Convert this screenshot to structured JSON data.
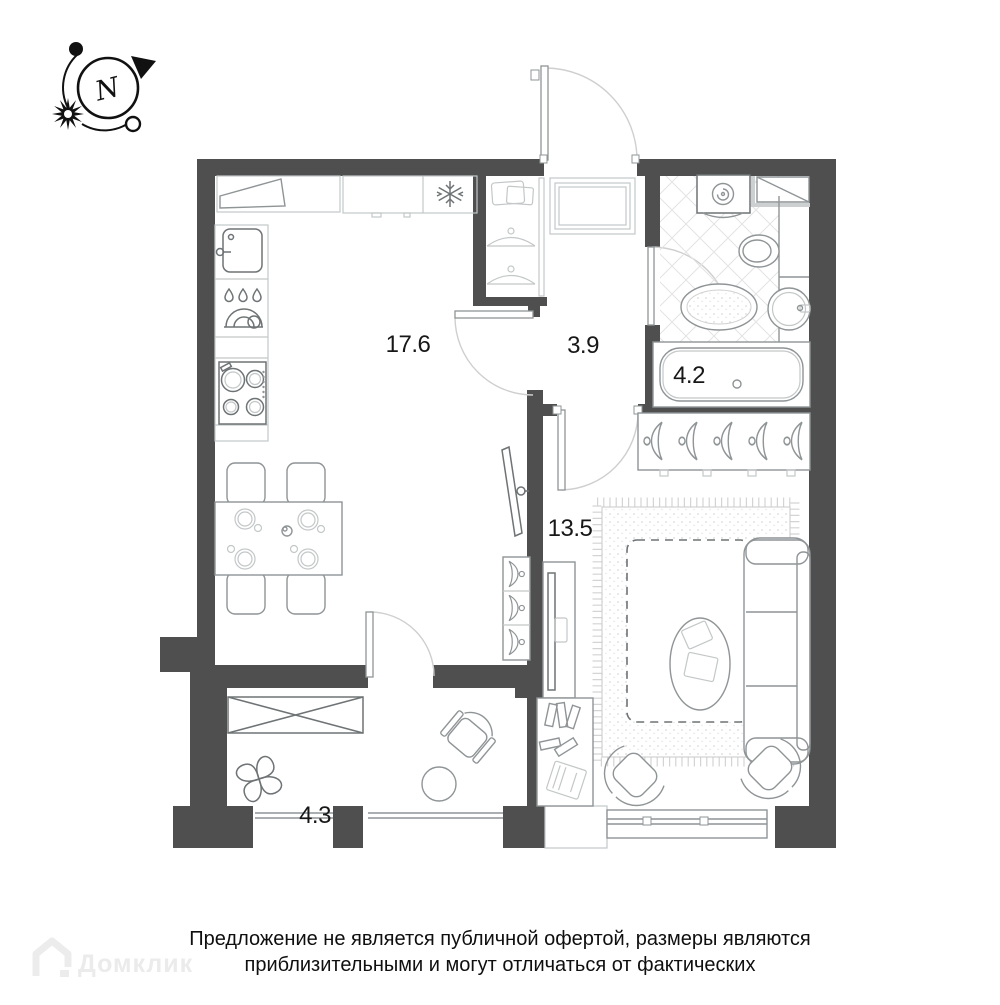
{
  "plan": {
    "compass": {
      "north_label": "N"
    },
    "rooms": [
      {
        "id": "kitchen-living",
        "area": "17.6"
      },
      {
        "id": "hall",
        "area": "3.9"
      },
      {
        "id": "bathroom",
        "area": "4.2"
      },
      {
        "id": "bedroom",
        "area": "13.5"
      },
      {
        "id": "balcony",
        "area": "4.3"
      }
    ],
    "colors": {
      "wall": "#4f4f4f",
      "furniture_line": "#8f9496",
      "light_line": "#c3c7c8",
      "door_arc": "#cfcfcf",
      "tile_line": "#e3e3e3",
      "text": "#171717",
      "watermark": "#ebebeb"
    }
  },
  "footer": {
    "watermark": "Домклик",
    "disclaimer_line1": "Предложение не является публичной офертой, размеры являются",
    "disclaimer_line2": "приблизительными и могут отличаться от фактических"
  }
}
